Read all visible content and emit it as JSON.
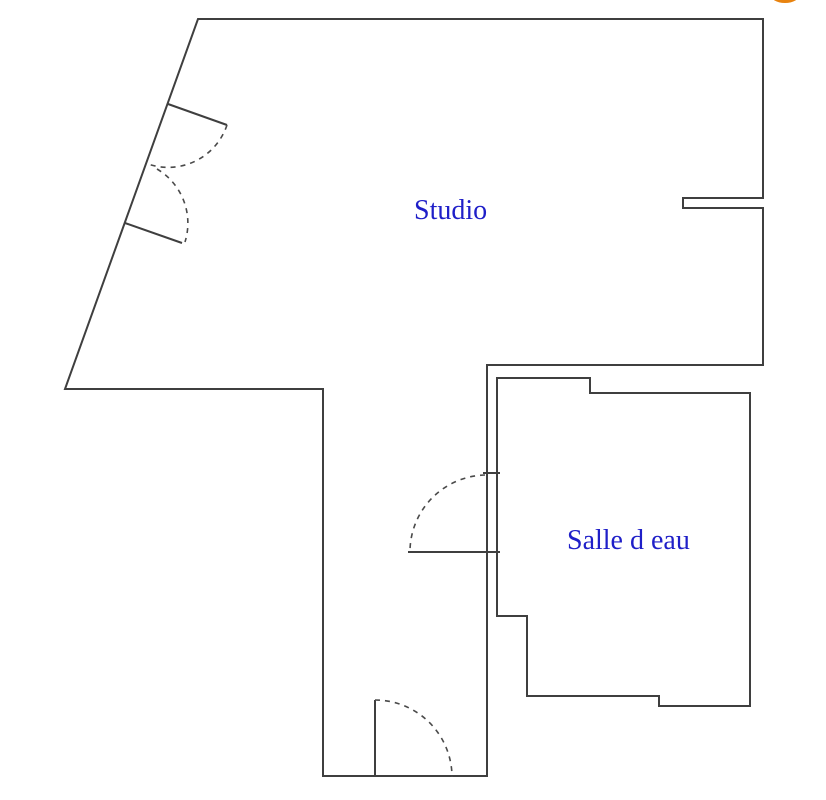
{
  "colors": {
    "background": "#ffffff",
    "wall": "#3f3f3f",
    "room_label": "#1f1fc8",
    "logo": "#e8830f"
  },
  "rooms": {
    "studio": {
      "label": "Studio"
    },
    "salle_d_eau": {
      "label": "Salle d eau"
    }
  },
  "floorplan": {
    "walls": [
      {
        "name": "outer-wall-outline",
        "closed": true,
        "points": [
          [
            198,
            19
          ],
          [
            763,
            19
          ],
          [
            763,
            198
          ],
          [
            683,
            198
          ],
          [
            683,
            208
          ],
          [
            763,
            208
          ],
          [
            763,
            365
          ],
          [
            487,
            365
          ],
          [
            487,
            776
          ],
          [
            323,
            776
          ],
          [
            323,
            389
          ],
          [
            65,
            389
          ]
        ]
      },
      {
        "name": "salle-d-eau-wall-outline",
        "closed": true,
        "points": [
          [
            497,
            378
          ],
          [
            590,
            378
          ],
          [
            590,
            393
          ],
          [
            750,
            393
          ],
          [
            750,
            706
          ],
          [
            659,
            706
          ],
          [
            659,
            696
          ],
          [
            527,
            696
          ],
          [
            527,
            616
          ],
          [
            497,
            616
          ]
        ]
      }
    ],
    "doors": [
      {
        "name": "studio-entry-door-upper",
        "leaf": [
          [
            168,
            104
          ],
          [
            227,
            125
          ]
        ],
        "arc": {
          "from": [
            227,
            125
          ],
          "to": [
            148,
            164
          ],
          "r": 62,
          "sweep": 1
        }
      },
      {
        "name": "studio-entry-door-lower",
        "leaf": [
          [
            125,
            223
          ],
          [
            182,
            243
          ]
        ],
        "arc": {
          "from": [
            157,
            169
          ],
          "to": [
            185,
            242
          ],
          "r": 63,
          "sweep": 1
        }
      },
      {
        "name": "salle-d-eau-door",
        "leaf": [
          [
            408,
            552
          ],
          [
            500,
            552
          ]
        ],
        "tick": [
          [
            483,
            473
          ],
          [
            500,
            473
          ]
        ],
        "arc": {
          "from": [
            485,
            475
          ],
          "to": [
            410,
            550
          ],
          "r": 77,
          "sweep": 0
        }
      },
      {
        "name": "corridor-bottom-door",
        "leaf": [
          [
            375,
            700
          ],
          [
            375,
            777
          ]
        ],
        "arc": {
          "from": [
            375,
            700
          ],
          "to": [
            452,
            777
          ],
          "r": 77,
          "sweep": 1
        }
      }
    ],
    "logo_dot": {
      "cx": 785,
      "cy": -6,
      "rx": 15,
      "ry": 9
    }
  }
}
